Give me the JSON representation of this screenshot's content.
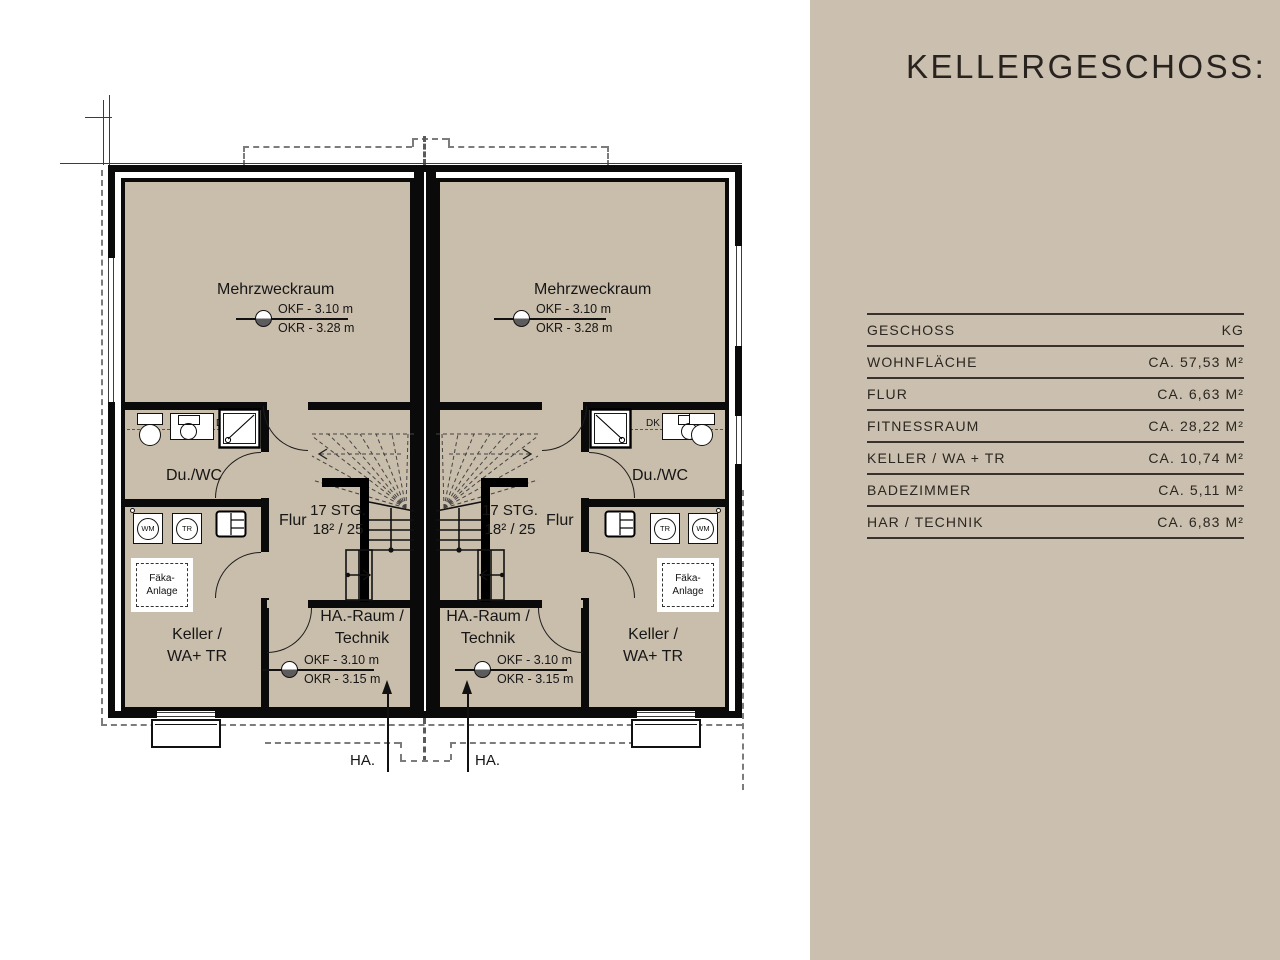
{
  "panel": {
    "title": "KELLERGESCHOSS:",
    "table": {
      "header_label": "GESCHOSS",
      "header_value": "KG",
      "rows": [
        {
          "label": "WOHNFLÄCHE",
          "value": "CA. 57,53 M²"
        },
        {
          "label": "FLUR",
          "value": "CA. 6,63 M²"
        },
        {
          "label": "FITNESSRAUM",
          "value": "CA. 28,22 M²"
        },
        {
          "label": "KELLER / WA + TR",
          "value": "CA. 10,74 M²"
        },
        {
          "label": "BADEZIMMER",
          "value": "CA. 5,11 M²"
        },
        {
          "label": "HAR / TECHNIK",
          "value": "CA. 6,83 M²"
        }
      ]
    }
  },
  "plan": {
    "rooms": {
      "mehrzweckraum": "Mehrzweckraum",
      "du_wc": "Du./WC",
      "flur": "Flur",
      "keller_1": "Keller /",
      "keller_2": "WA+ TR",
      "ha_raum_1": "HA.-Raum /",
      "ha_raum_2": "Technik"
    },
    "stairs": {
      "line1": "17 STG.",
      "line2": "18² / 25"
    },
    "markers": {
      "okf_upper": "OKF - 3.10 m",
      "okr_upper": "OKR - 3.28 m",
      "okf_lower": "OKF - 3.10 m",
      "okr_lower": "OKR - 3.15 m"
    },
    "fixtures": {
      "dk": "DK",
      "wm": "WM",
      "tr": "TR",
      "faeka_1": "Fäka-",
      "faeka_2": "Anlage"
    },
    "ha_label": "HA."
  },
  "colors": {
    "panel_bg": "#cbc0af",
    "room_fill": "#c9bdab",
    "wall": "#0a0a0a",
    "text": "#2b2620"
  }
}
